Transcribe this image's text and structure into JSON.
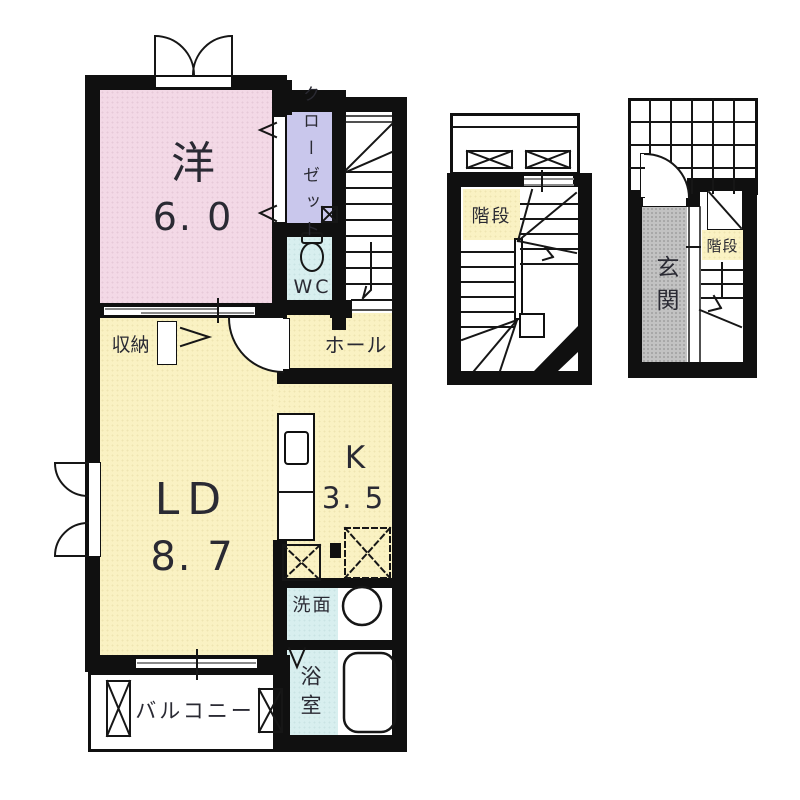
{
  "colors": {
    "wall": "#101010",
    "ink": "#2a2a33",
    "line": "#161616",
    "room-pink": "#f3d9e6",
    "room-lavender": "#c9c7ec",
    "room-cyan": "#d8efef",
    "room-yellow": "#faf2c3",
    "room-gray": "#c2c2c2"
  },
  "plan": {
    "main": {
      "west_room": {
        "label": "洋",
        "area": "6. 0"
      },
      "closet": {
        "label": "クローゼット"
      },
      "wc": {
        "label": "WC"
      },
      "storage": {
        "label": "収納"
      },
      "hall": {
        "label": "ホール"
      },
      "living_dining": {
        "label": "LD",
        "area": "8. 7"
      },
      "kitchen": {
        "label": "K",
        "area": "3. 5"
      },
      "washroom": {
        "label": "洗面"
      },
      "bathroom": {
        "label": "浴室"
      },
      "balcony": {
        "label": "バルコニー"
      }
    },
    "middle": {
      "stairs": {
        "label": "階段"
      }
    },
    "right": {
      "entrance": {
        "label": "玄関"
      },
      "stairs": {
        "label": "階段"
      }
    }
  }
}
